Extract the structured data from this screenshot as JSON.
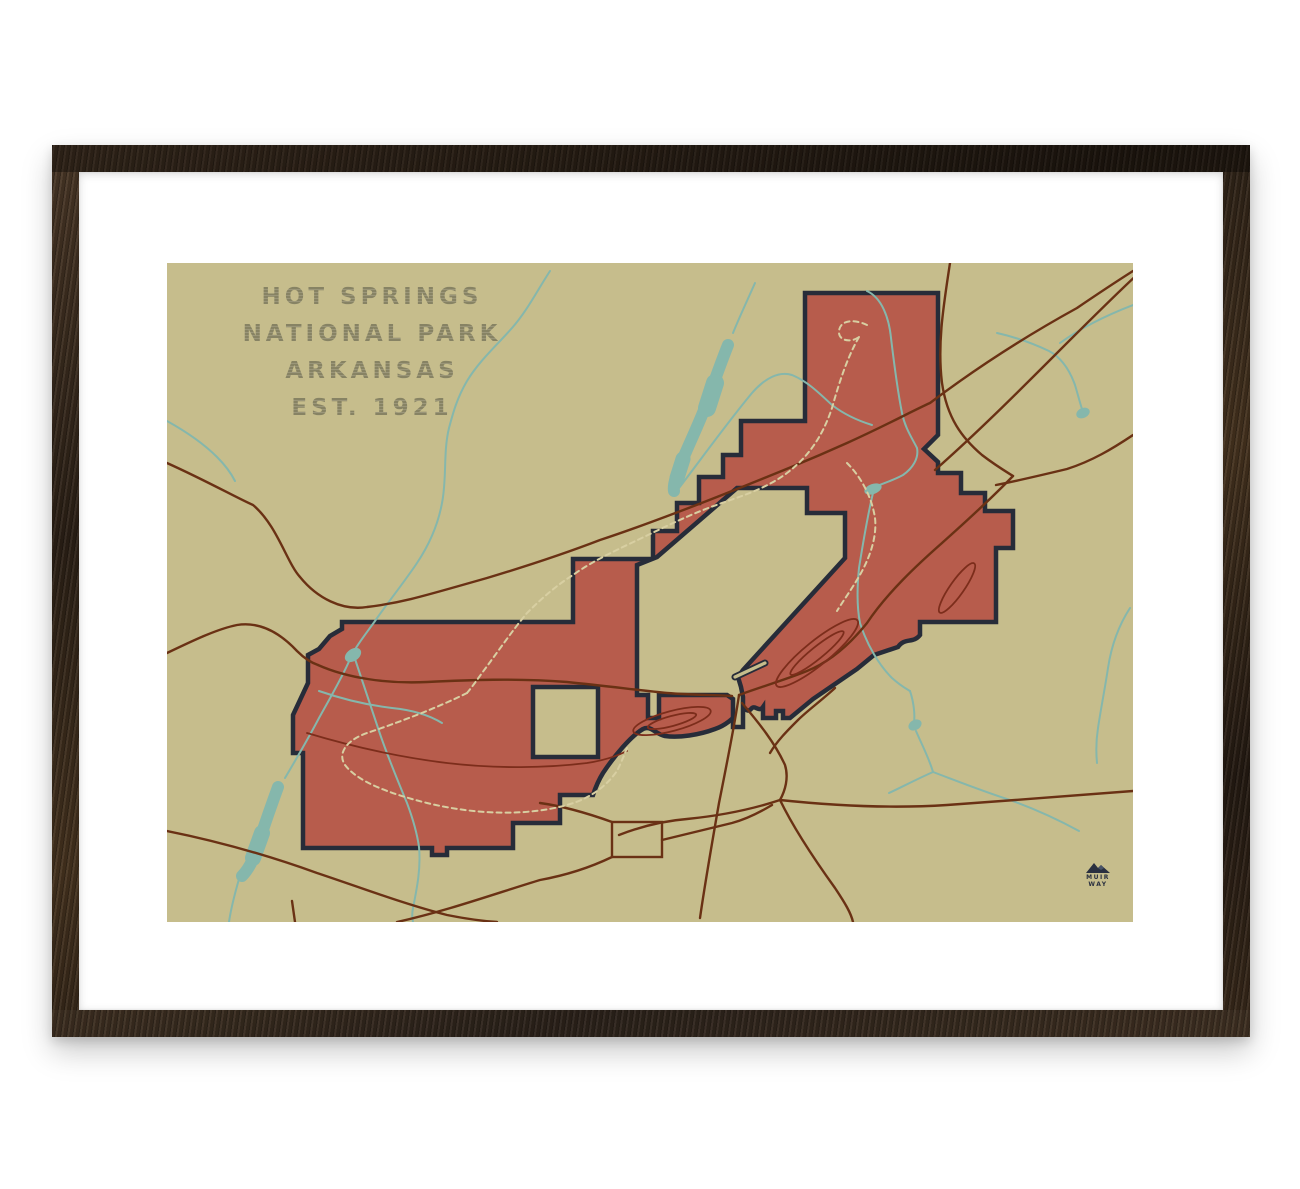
{
  "artwork": {
    "title": {
      "line1": "HOT SPRINGS",
      "line2": "NATIONAL PARK",
      "line3": "ARKANSAS",
      "line4": "EST. 1921"
    },
    "brand": {
      "name_line1": "MUIR",
      "name_line2": "WAY",
      "icon": "mountain-icon"
    },
    "palette": {
      "paper": "#c6bd8c",
      "park_fill": "#b75c4c",
      "park_boundary": "#272c39",
      "water": "#85b7ac",
      "road": "#6a3114",
      "park_road": "#7c2d1b",
      "trail": "#d8cfa2",
      "title_text": "#8c8869",
      "frame_wood": "#3a2b1d",
      "mat": "#ffffff"
    }
  }
}
